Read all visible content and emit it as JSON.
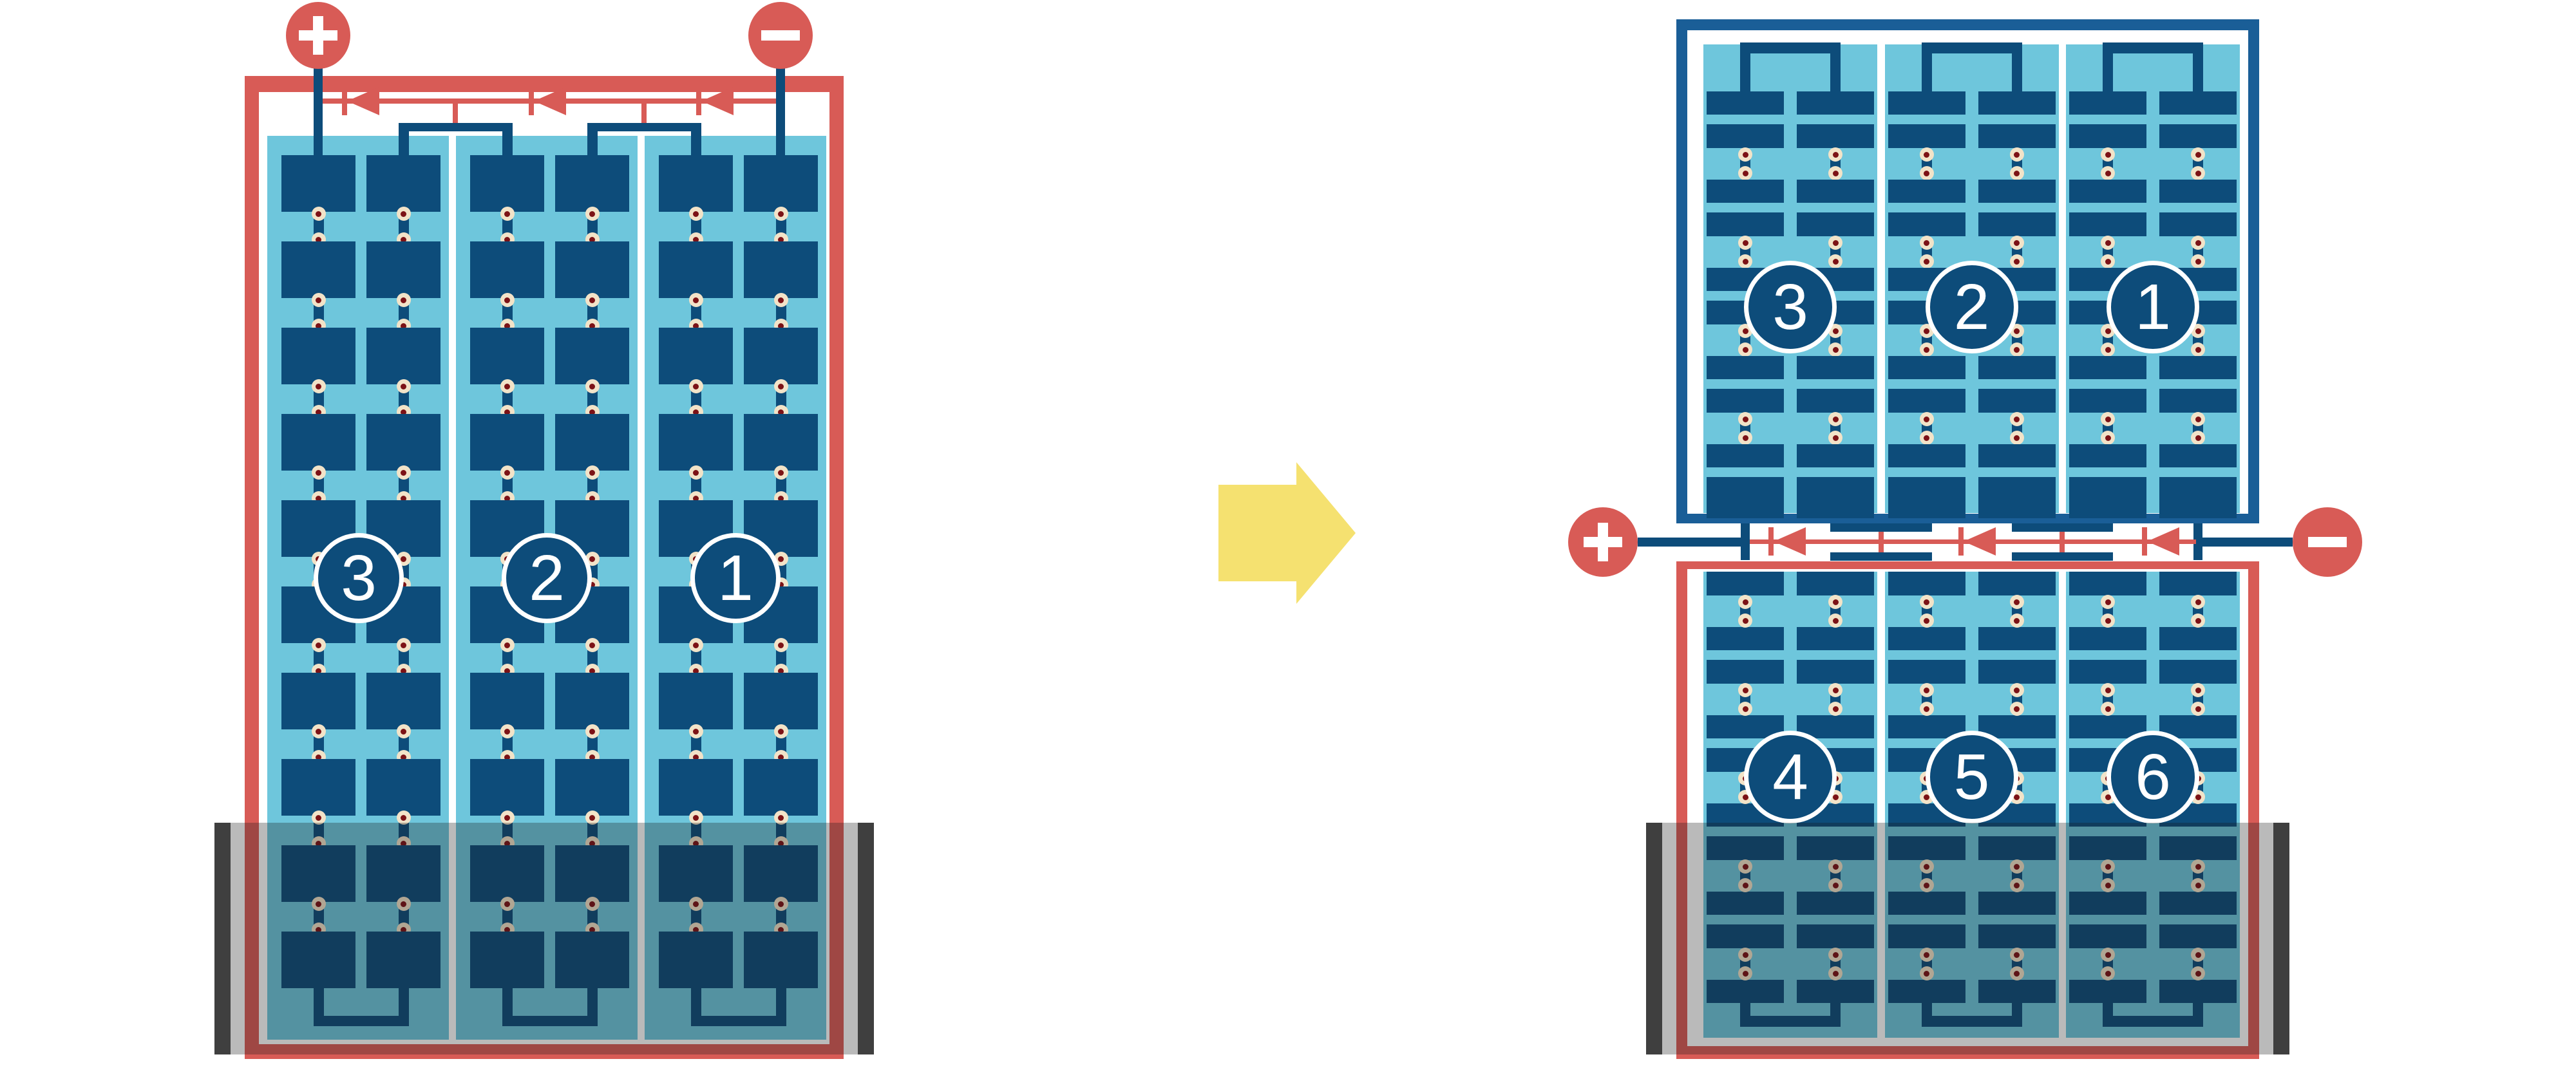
{
  "figure": {
    "type": "solar-module-bypass-diode-diagram",
    "colors": {
      "background": "#FFFFFF",
      "panel_bg": "#6EC6DC",
      "cell": "#0D4C7A",
      "wire": "#0D4C7A",
      "frame_red": "#D85B56",
      "frame_blue": "#1A5E97",
      "diode_red": "#D85B56",
      "terminal_red": "#D85B56",
      "terminal_sign": "#FFFFFF",
      "dot_outer": "#F2E3C8",
      "dot_inner": "#7C1216",
      "circle_fill": "#0D4C7A",
      "circle_border": "#FFFFFF",
      "number_text": "#FFFFFF",
      "shade": "rgba(25,25,25,0.3)",
      "shade_cap": "#3F3F3F",
      "arrow": "#F5E170"
    },
    "left_module": {
      "string_labels": [
        "3",
        "2",
        "1"
      ],
      "positive_terminal": "+",
      "negative_terminal": "−",
      "diode_count": 3
    },
    "right_top_module": {
      "string_labels": [
        "3",
        "2",
        "1"
      ]
    },
    "right_bottom_module": {
      "string_labels": [
        "4",
        "5",
        "6"
      ],
      "positive_terminal": "+",
      "negative_terminal": "−",
      "diode_count": 3
    },
    "arrow": {
      "direction": "right"
    }
  }
}
